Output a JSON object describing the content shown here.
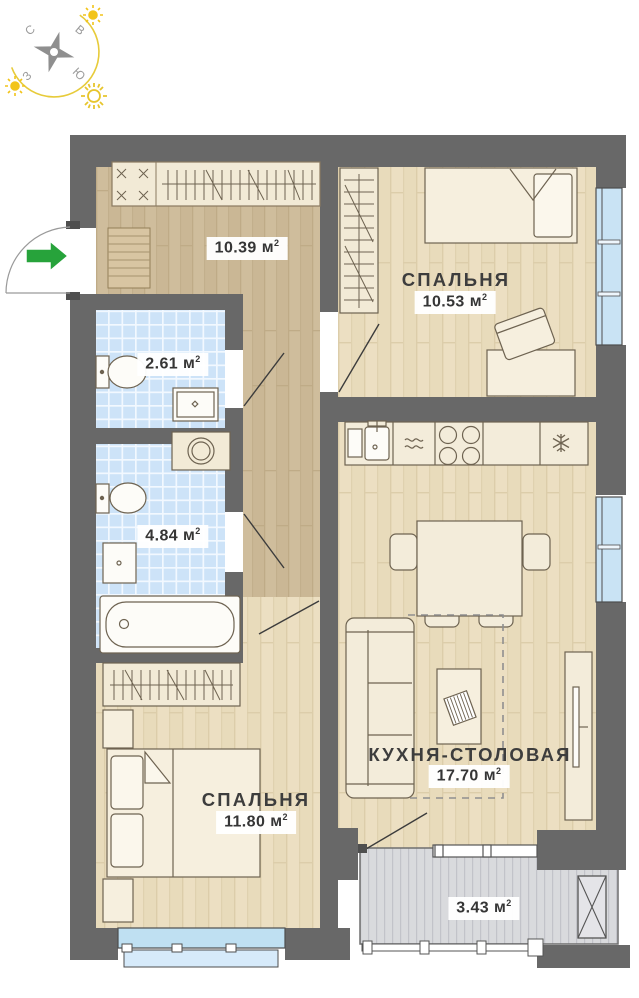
{
  "compass": {
    "north": "С",
    "east": "В",
    "west": "З",
    "south": "Ю"
  },
  "rooms": {
    "hallway": {
      "area": "10.39",
      "unit": "м",
      "sup": "2"
    },
    "wc": {
      "area": "2.61",
      "unit": "м",
      "sup": "2"
    },
    "bathroom": {
      "area": "4.84",
      "unit": "м",
      "sup": "2"
    },
    "bedroom1": {
      "name": "СПАЛЬНЯ",
      "area": "10.53",
      "unit": "м",
      "sup": "2"
    },
    "bedroom2": {
      "name": "СПАЛЬНЯ",
      "area": "11.80",
      "unit": "м",
      "sup": "2"
    },
    "kitchen": {
      "name": "КУХНЯ-СТОЛОВАЯ",
      "area": "17.70",
      "unit": "м",
      "sup": "2"
    },
    "balcony": {
      "area": "3.43",
      "unit": "м",
      "sup": "2"
    }
  },
  "icons": {
    "entry_arrow": "green-right-arrow",
    "compass_star": "four-point-star",
    "sun": "sun",
    "fridge": "snowflake",
    "dishwasher": "waves"
  },
  "colors": {
    "wall": "#686868",
    "floor_light": "#ecdfc2",
    "floor_dark": "#cfbd9c",
    "tile": "#cde3f8",
    "window_glass": "#c9e3f4",
    "deck": "#d9dadd",
    "entry_arrow": "#27a33b",
    "sun": "#eec91f",
    "label_text": "#3d3d3d"
  }
}
